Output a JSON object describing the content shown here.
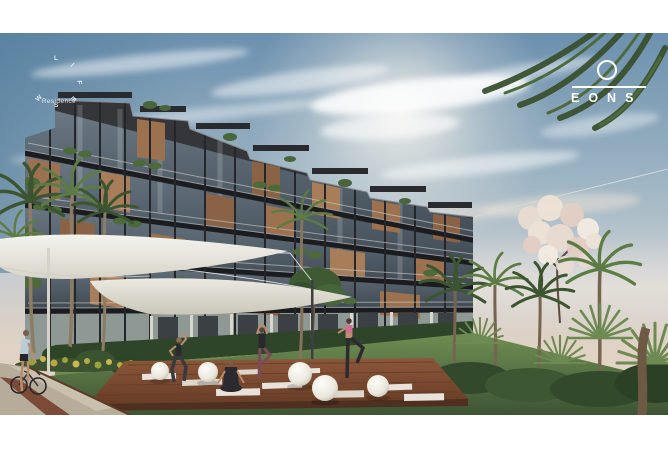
{
  "brand": {
    "logo_text": "EONS"
  },
  "watermark": {
    "center_text": "Residence",
    "arc_letters": [
      "L",
      "I",
      "F",
      "E",
      "S",
      "W"
    ]
  },
  "photo": {
    "label": "architectural-exterior-render"
  },
  "scene": {
    "elements": [
      "residential-building",
      "shade-sails",
      "yoga-deck",
      "yoga-practitioners",
      "sphere-lamps",
      "palm-garden",
      "flowering-tree",
      "cyclist",
      "stone-path",
      "hedge"
    ]
  },
  "palette": {
    "sky_top": "#6b90ae",
    "sky_horizon": "#e8d5c3",
    "building_frame": "#35363a",
    "wood_panel": "#9b7150",
    "glass": "#5a6b79",
    "foliage": "#3c5530",
    "lawn": "#5c7a43",
    "deck": "#7d4d34",
    "sail": "#edebe3",
    "path": "#b7ac9a",
    "lamp": "#f3f1ea",
    "accent_pink": "#cf6f92",
    "logo_white": "#ffffff"
  }
}
